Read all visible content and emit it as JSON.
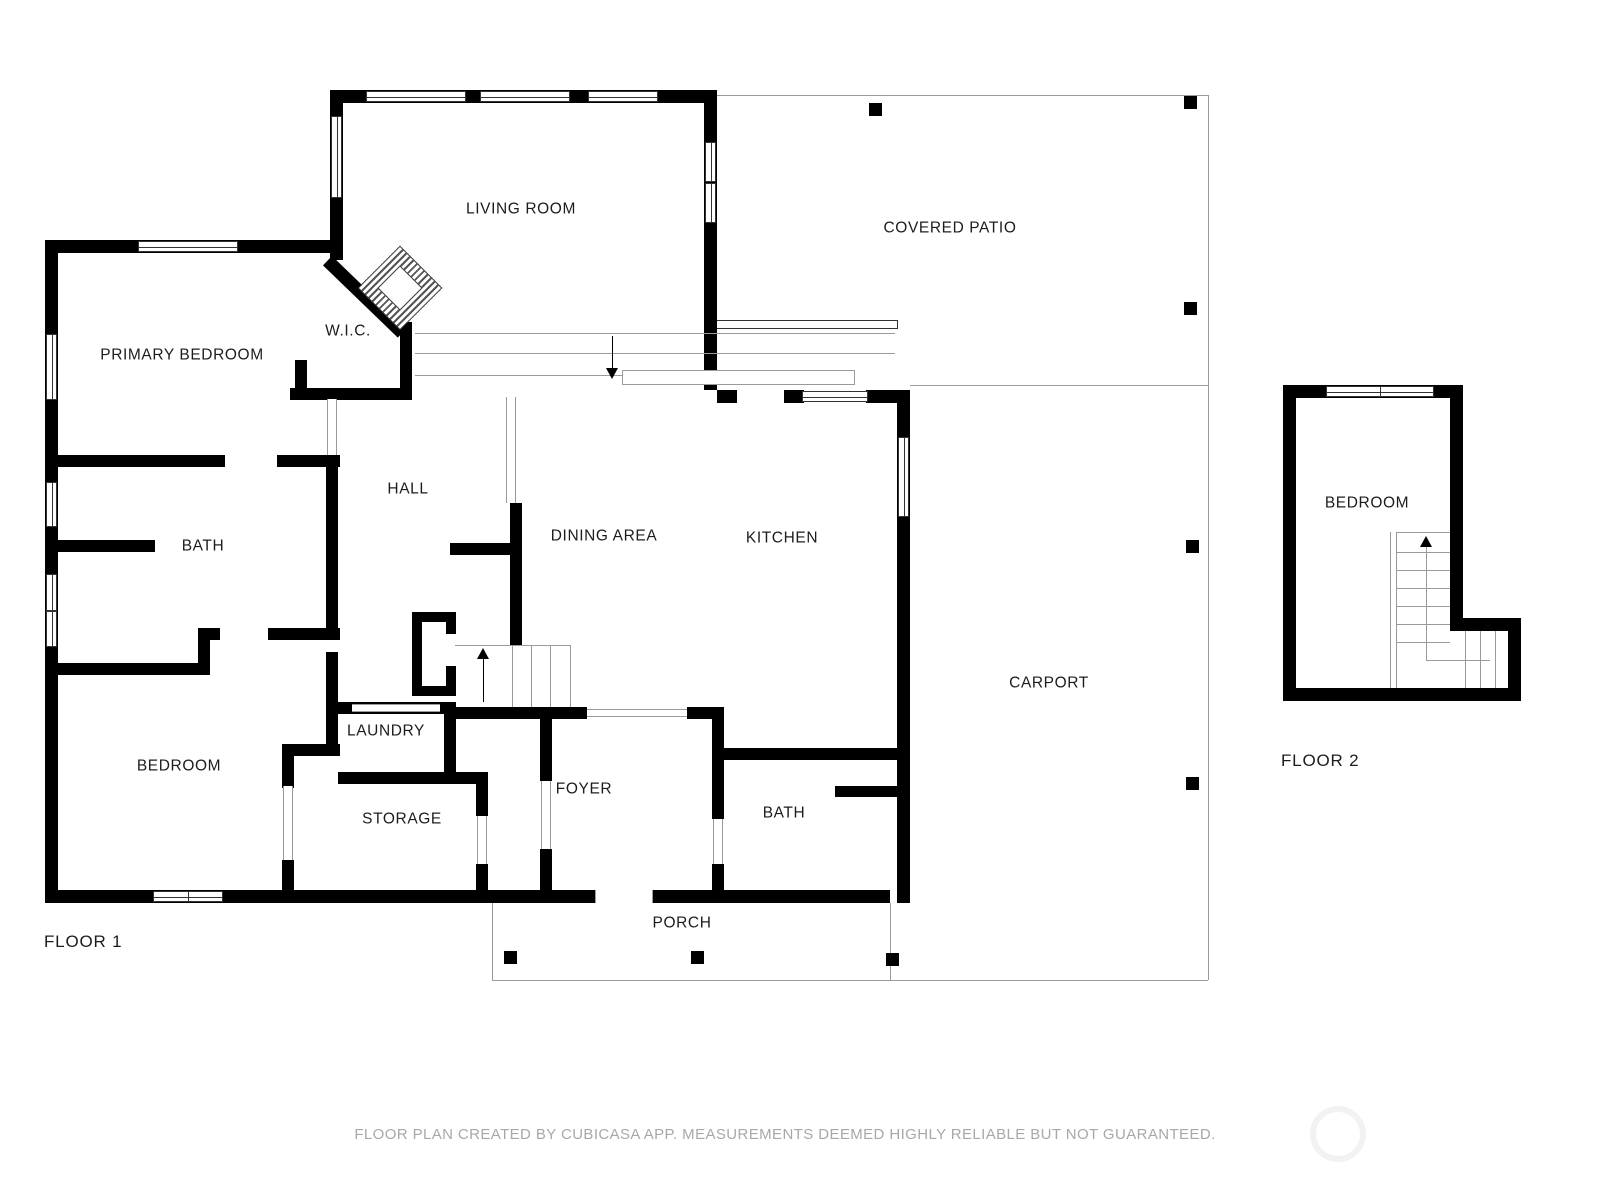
{
  "floors": {
    "floor1": {
      "label": "FLOOR 1",
      "rooms": {
        "living_room": "LIVING ROOM",
        "covered_patio": "COVERED PATIO",
        "primary_bedroom": "PRIMARY BEDROOM",
        "wic": "W.I.C.",
        "hall": "HALL",
        "bath": "BATH",
        "dining_area": "DINING AREA",
        "kitchen": "KITCHEN",
        "carport": "CARPORT",
        "bedroom": "BEDROOM",
        "laundry": "LAUNDRY",
        "storage": "STORAGE",
        "foyer": "FOYER",
        "bath2": "BATH",
        "porch": "PORCH"
      }
    },
    "floor2": {
      "label": "FLOOR 2",
      "rooms": {
        "bedroom": "BEDROOM"
      }
    }
  },
  "footer": {
    "disclaimer": "FLOOR PLAN CREATED BY CUBICASA APP. MEASUREMENTS DEEMED HIGHLY RELIABLE BUT NOT GUARANTEED."
  },
  "colors": {
    "wall": "#000000",
    "outline": "#9a9a9a",
    "window_frame": "#333333",
    "label": "#1c1c1c",
    "footer_text": "#a8a8a8",
    "watermark": "#f2f2f2"
  }
}
